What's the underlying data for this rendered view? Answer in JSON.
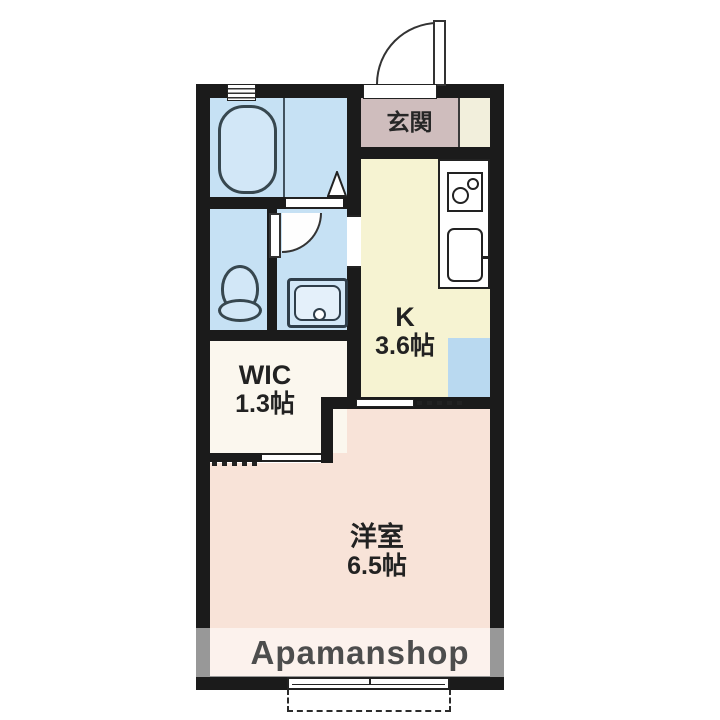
{
  "floorplan": {
    "watermark": "Apamanshop",
    "rooms": {
      "genkan": {
        "label": "玄関"
      },
      "kitchen": {
        "label": "K",
        "size": "3.6帖"
      },
      "wic": {
        "label": "WIC",
        "size": "1.3帖"
      },
      "western": {
        "label": "洋室",
        "size": "6.5帖"
      }
    },
    "icons": {
      "bathtub": "bathtub-icon",
      "toilet": "toilet-icon",
      "washbasin": "washbasin-icon",
      "stove": "stove-burners-icon",
      "kitchen_sink": "kitchen-sink-icon",
      "entrance_door": "door-swing-arc-icon",
      "washroom_door": "door-swing-arc-icon",
      "bath_door": "folding-door-triangle-icon",
      "window": "sliding-window-icon",
      "balcony": "balcony-dashed-outline"
    },
    "colors": {
      "wall": "#1b1b1b",
      "wet_area": "#c6e1f4",
      "kitchen": "#f6f3d2",
      "entrance": "#cfbdbd",
      "wic": "#fbf7ee",
      "western_room": "#f8e3d8",
      "appliance_pad": "#b9d9f0",
      "watermark_text": "#4d4d4d"
    }
  }
}
